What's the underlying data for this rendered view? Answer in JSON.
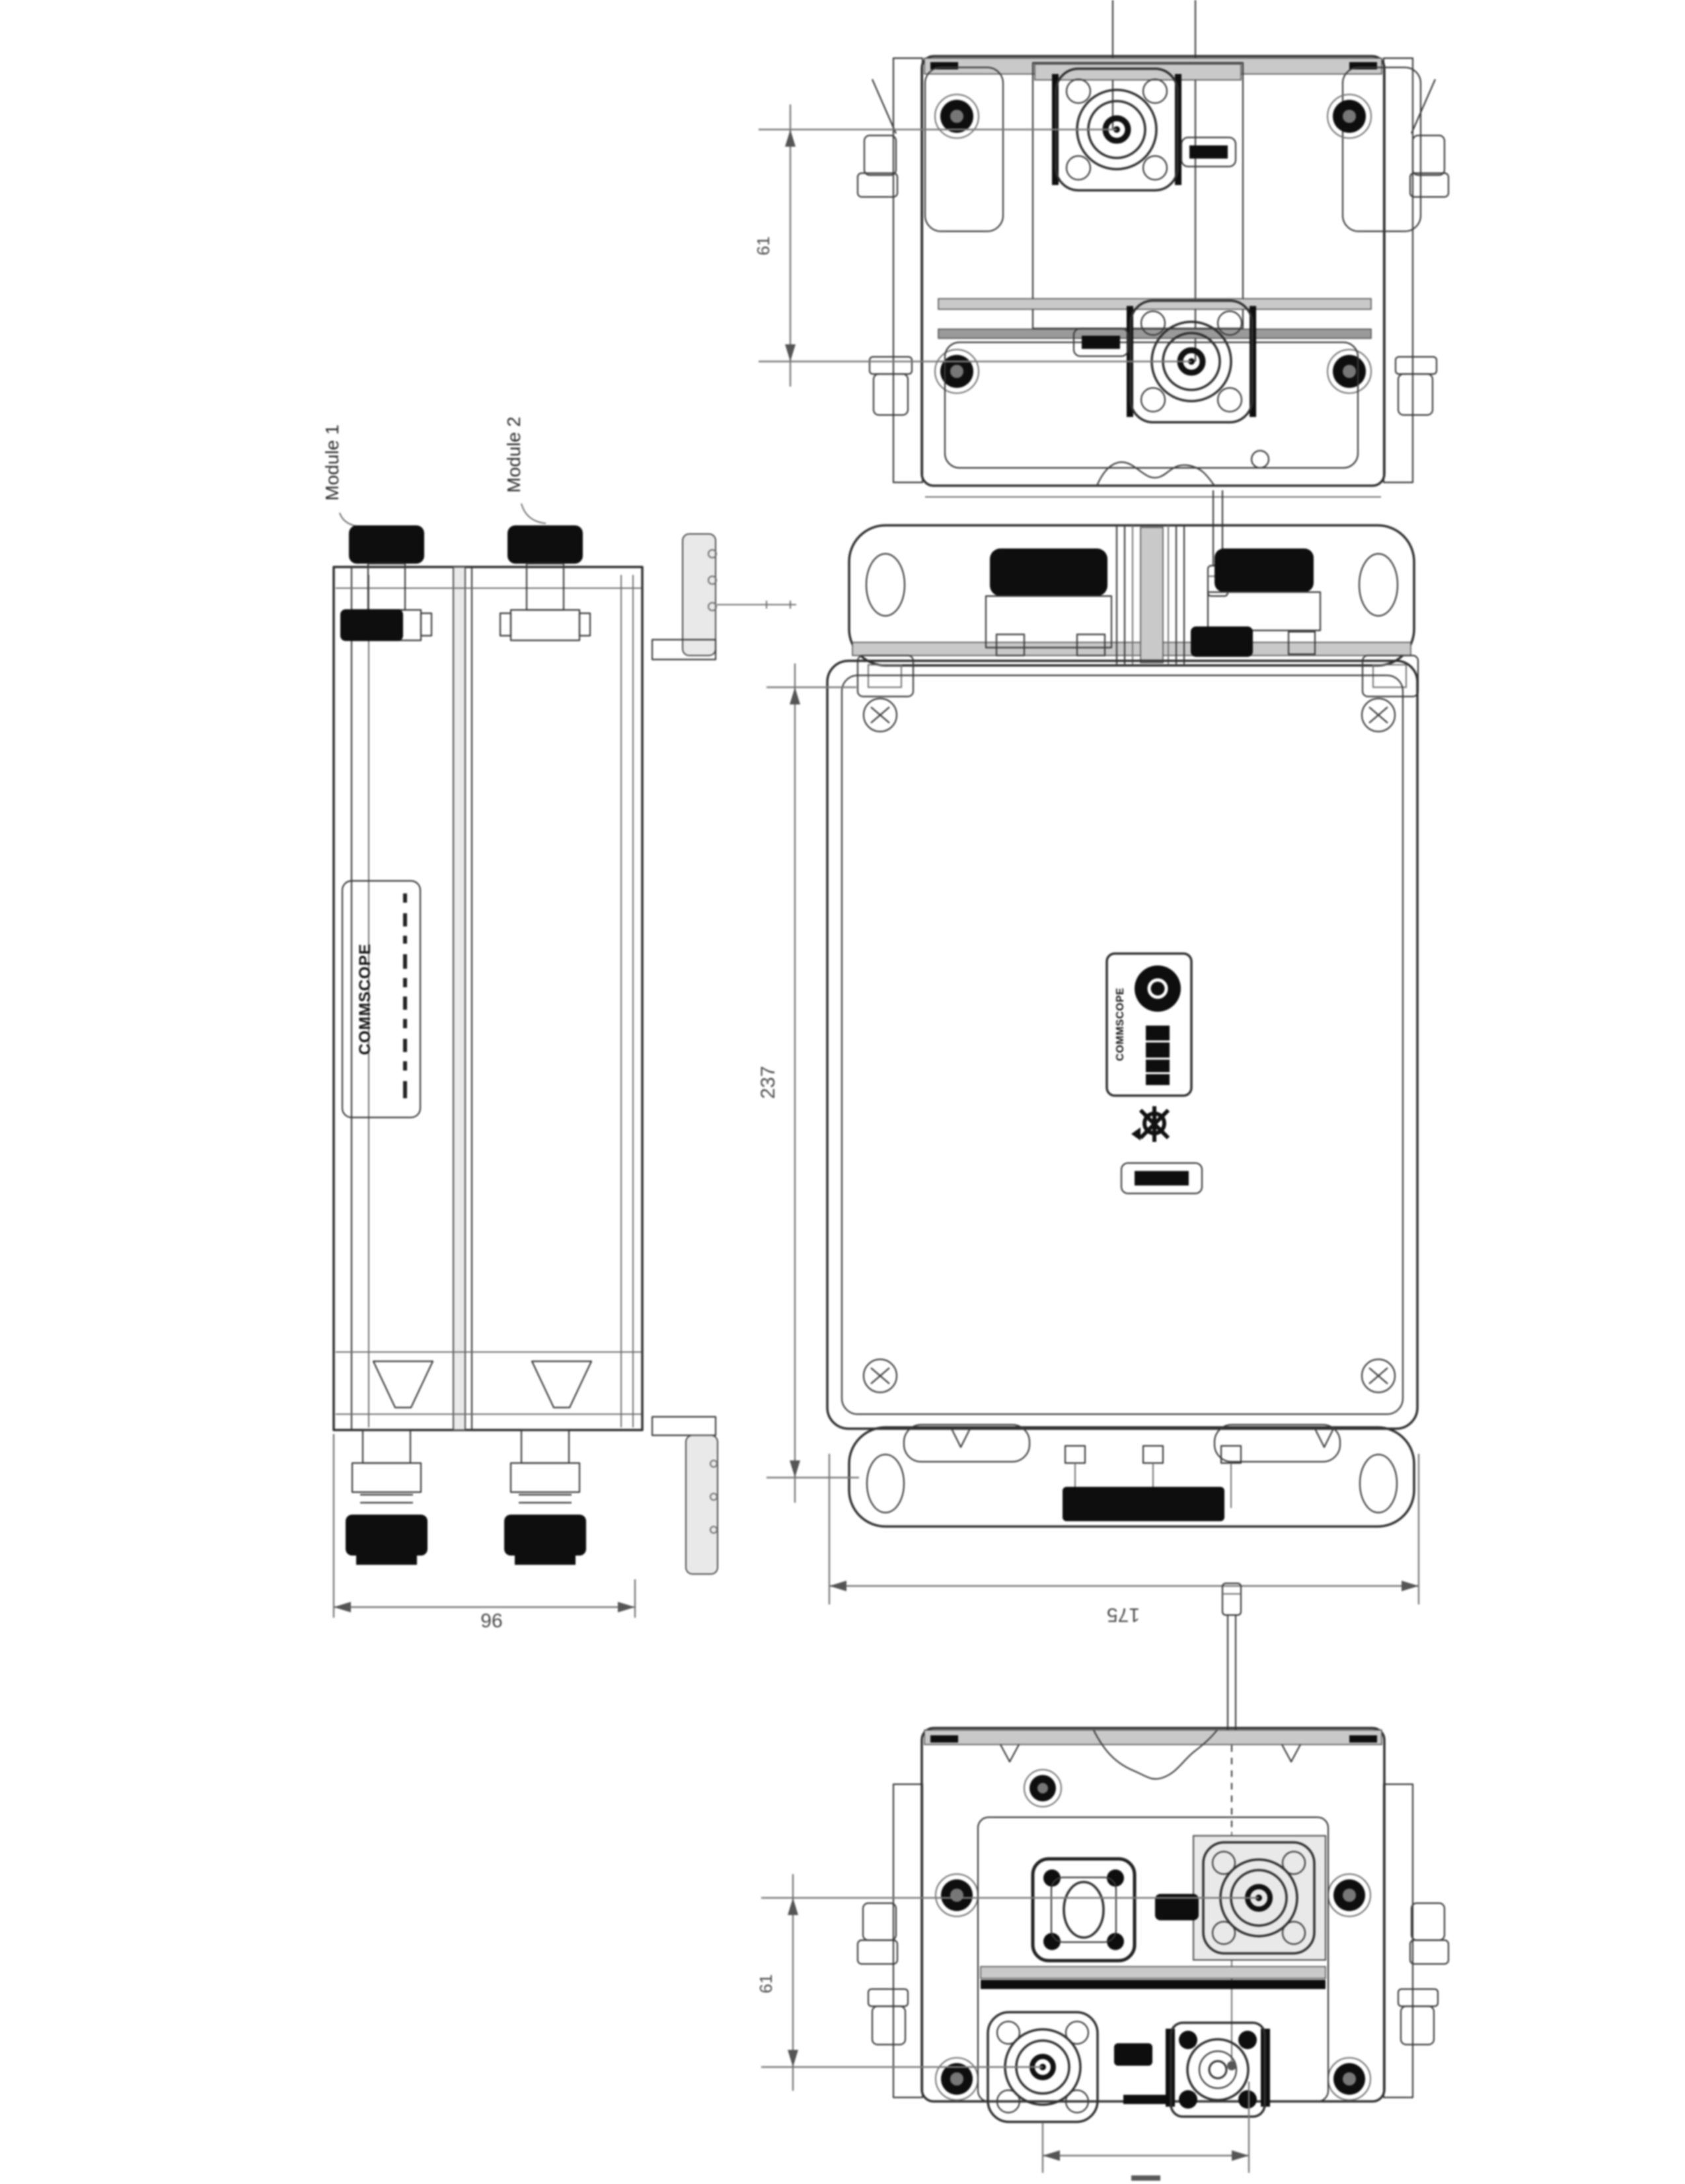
{
  "page": {
    "background": "#ffffff",
    "line_color": "#2f2f2f",
    "black_fill": "#0e0e0e",
    "dim_color": "#7a7a7a"
  },
  "labels": {
    "module1": "Module 1",
    "module2": "Module 2",
    "side_brand": "COMMSCOPE",
    "front_brand": "COMMSCOPE"
  },
  "dimensions": {
    "overall_height": "237",
    "overall_width": "175",
    "overall_depth": "96",
    "port_spacing_top": "61",
    "port_spacing_bottom": "61"
  },
  "views": {
    "top_view": "top view with two N-type connectors",
    "side_view": "left side view with module caps and brackets",
    "front_view": "front view with product label",
    "bottom_view": "bottom view with four connectors and grounding rod"
  }
}
